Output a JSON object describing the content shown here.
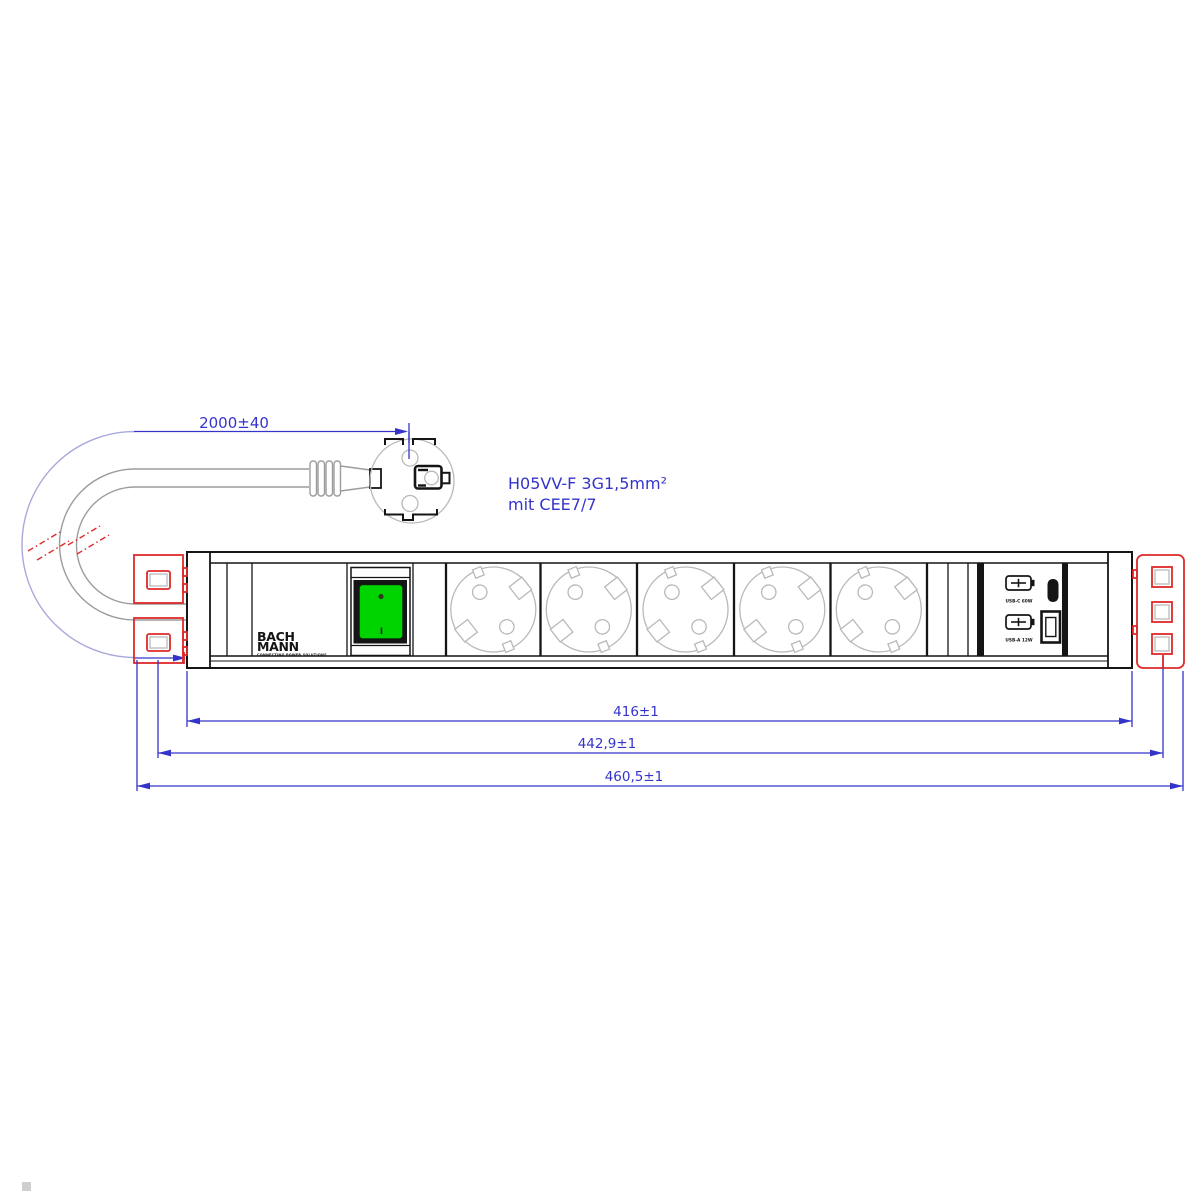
{
  "annotations": {
    "cable_length": "2000±40",
    "cable_spec_line1": "H05VV-F 3G1,5mm²",
    "cable_spec_line2": "mit CEE7/7",
    "dim_body": "416±1",
    "dim_mounting": "442,9±1",
    "dim_overall": "460,5±1"
  },
  "strip": {
    "brand_line1": "BACH",
    "brand_line2": "MANN",
    "brand_tagline": "CONNECTING POWER SOLUTIONS",
    "switch_mark": "I",
    "usb_top_label": "USB-C 60W",
    "usb_bottom_label": "USB-A 12W",
    "socket_count": 5
  },
  "colors": {
    "dimension_blue": "#3434cb",
    "arc_lavender": "#a9a9dc",
    "bracket_red": "#de2a2a",
    "switch_green": "#00d400",
    "cable_gray": "#9c9c9c",
    "socket_gray": "#b9b9b9",
    "line_black": "#151515"
  }
}
